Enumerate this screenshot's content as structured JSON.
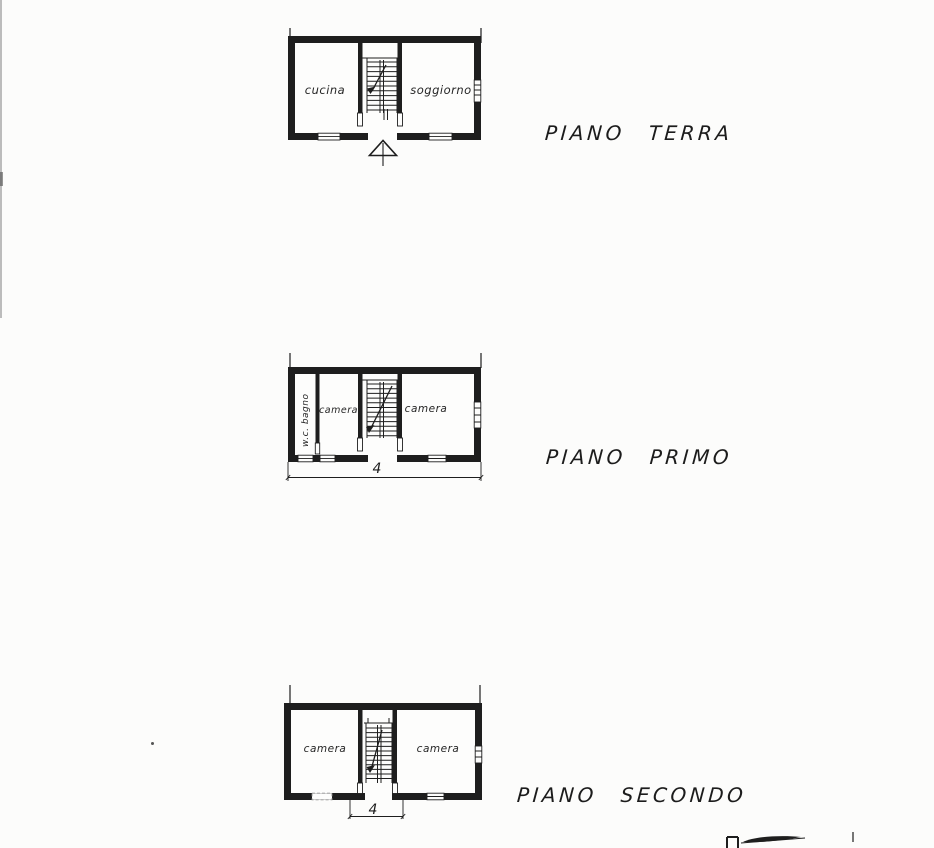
{
  "document": {
    "kind": "scanned architectural floor plan sheet",
    "ink_color": "#1e1e1e",
    "paper_color": "#fcfcfb"
  },
  "icons": {
    "entrance_arrow": "hollow triangle with vertical line (main entrance indicator)",
    "stair_direction_arrow": "diagonal line with solid arrowhead inside staircase"
  },
  "floors": [
    {
      "title": "PIANO TERRA",
      "rooms": [
        {
          "label": "cucina"
        },
        {
          "label": "soggiorno"
        }
      ]
    },
    {
      "title": "PIANO PRIMO",
      "rooms": [
        {
          "label": "w.c. bagno"
        },
        {
          "label": "camera"
        },
        {
          "label": "camera"
        }
      ],
      "dimension_label": "4"
    },
    {
      "title": "PIANO SECONDO",
      "rooms": [
        {
          "label": "camera"
        },
        {
          "label": "camera"
        }
      ],
      "dimension_label": "4"
    }
  ]
}
